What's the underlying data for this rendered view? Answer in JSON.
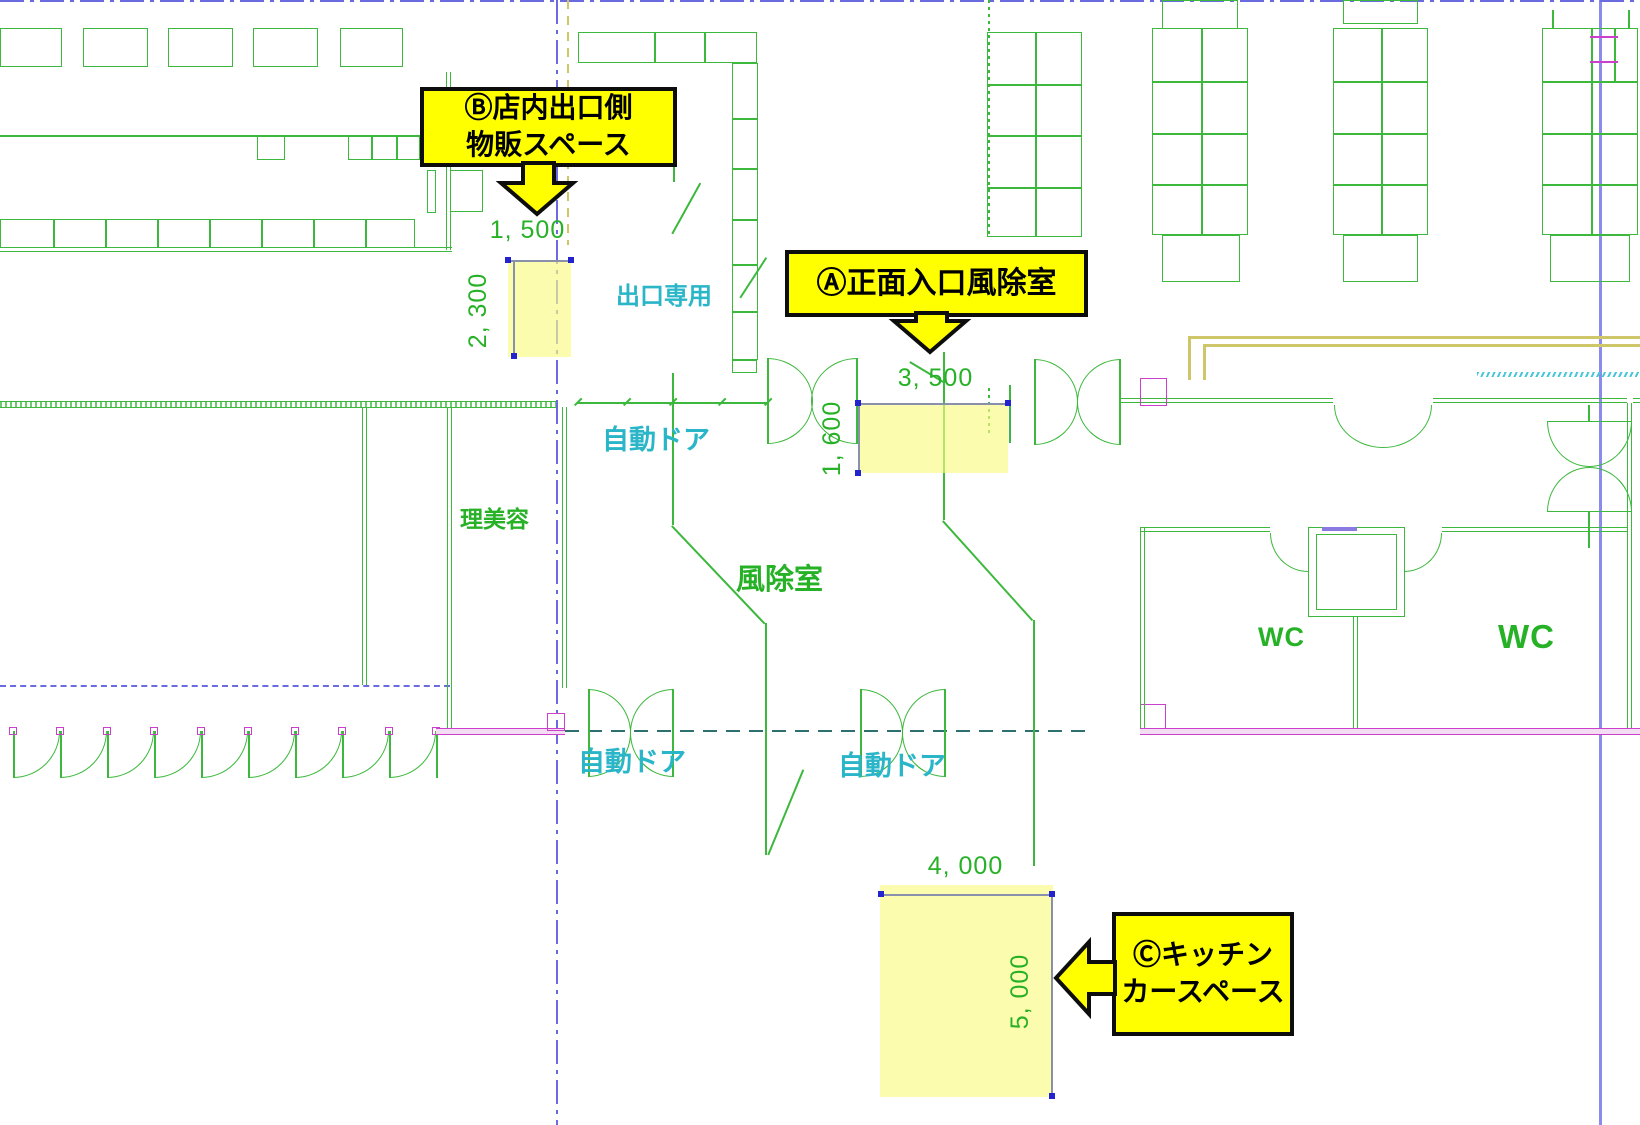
{
  "callouts": {
    "a": {
      "label": "Ⓐ正面入口風除室"
    },
    "b": {
      "line1": "Ⓑ店内出口側",
      "line2": "物販スペース"
    },
    "c": {
      "line1": "Ⓒキッチン",
      "line2": "カースペース"
    }
  },
  "dimensions": {
    "b_width": "1, 500",
    "b_height": "2, 300",
    "a_width": "3, 500",
    "a_height": "1, 600",
    "c_width": "4, 000",
    "c_height": "5, 000"
  },
  "labels": {
    "exit_only": "出口専用",
    "auto_door_top": "自動ドア",
    "auto_door_bottom_left": "自動ドア",
    "auto_door_bottom_right": "自動ドア",
    "barber": "理美容",
    "windbreak": "風除室",
    "wc_left": "WC",
    "wc_right": "WC"
  },
  "colors": {
    "wall_green": "#3cb83c",
    "text_green": "#27b127",
    "label_cyan": "#2ab6c8",
    "centerline_blue": "#6b6be0",
    "magenta": "#cc3fcc",
    "olive": "#cfc66a",
    "highlight_yellow": "#fafa82",
    "callout_yellow": "#ffff00",
    "dim_gray": "#8890ac",
    "dot_blue": "#2323cf"
  }
}
